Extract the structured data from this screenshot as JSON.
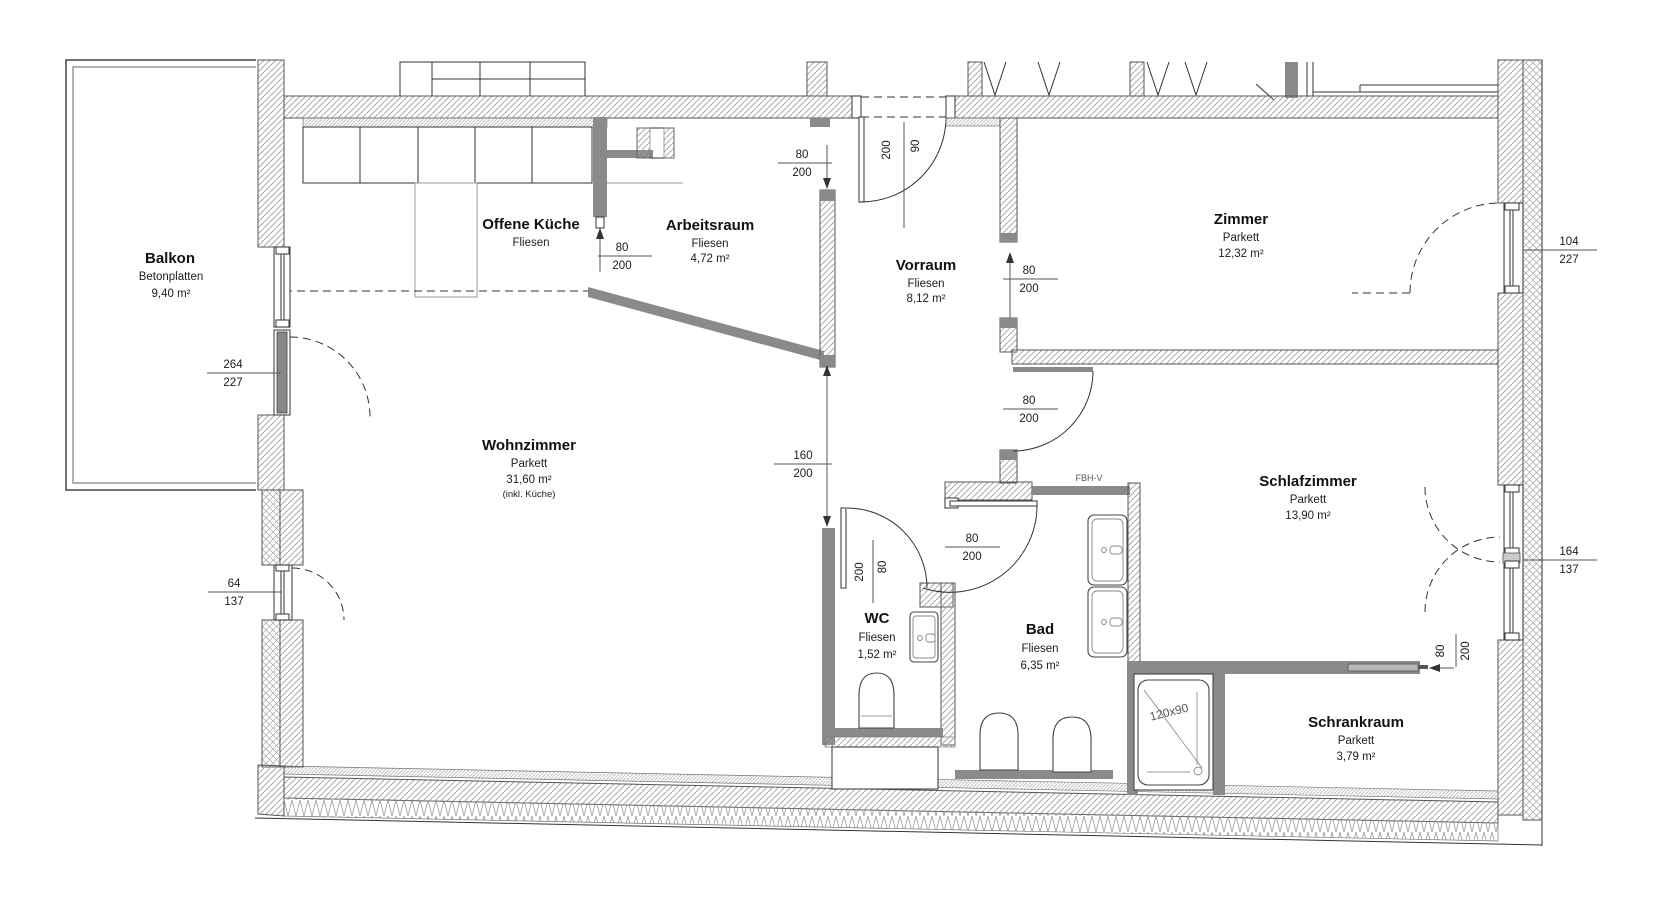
{
  "style": {
    "wall_gray": "#8a8a8a",
    "hatch_color": "#9e9e9e",
    "line_dark": "#333333",
    "background": "#ffffff"
  },
  "rooms": {
    "balkon": {
      "name": "Balkon",
      "floor": "Betonplatten",
      "area": "9,40 m²"
    },
    "kueche": {
      "name": "Offene Küche",
      "floor": "Fliesen"
    },
    "arbeitsraum": {
      "name": "Arbeitsraum",
      "floor": "Fliesen",
      "area": "4,72 m²"
    },
    "vorraum": {
      "name": "Vorraum",
      "floor": "Fliesen",
      "area": "8,12 m²"
    },
    "zimmer": {
      "name": "Zimmer",
      "floor": "Parkett",
      "area": "12,32 m²"
    },
    "wohnzimmer": {
      "name": "Wohnzimmer",
      "floor": "Parkett",
      "area": "31,60 m²",
      "note": "(inkl. Küche)"
    },
    "schlafzimmer": {
      "name": "Schlafzimmer",
      "floor": "Parkett",
      "area": "13,90 m²"
    },
    "wc": {
      "name": "WC",
      "floor": "Fliesen",
      "area": "1,52 m²"
    },
    "bad": {
      "name": "Bad",
      "floor": "Fliesen",
      "area": "6,35 m²"
    },
    "schrankraum": {
      "name": "Schrankraum",
      "floor": "Parkett",
      "area": "3,79 m²"
    }
  },
  "dims": {
    "balkon_door": {
      "a": "264",
      "b": "227"
    },
    "wohn_window": {
      "a": "64",
      "b": "137"
    },
    "zimmer_window": {
      "a": "104",
      "b": "227"
    },
    "schlaf_window": {
      "a": "164",
      "b": "137"
    },
    "entry_door": {
      "a": "200",
      "b": "90"
    },
    "entry_opening": {
      "a": "80",
      "b": "200"
    },
    "kueche_door": {
      "a": "80",
      "b": "200"
    },
    "zimmer_door": {
      "a": "80",
      "b": "200"
    },
    "schlaf_door": {
      "a": "80",
      "b": "200"
    },
    "wohn_opening": {
      "a": "160",
      "b": "200"
    },
    "wc_door": {
      "a": "80",
      "b": "200"
    },
    "bad_door": {
      "a": "80",
      "b": "200"
    },
    "schrank_door": {
      "a": "80",
      "b": "200"
    }
  },
  "annotations": {
    "fbhv": "FBH-V",
    "shower_size": "120x90"
  }
}
